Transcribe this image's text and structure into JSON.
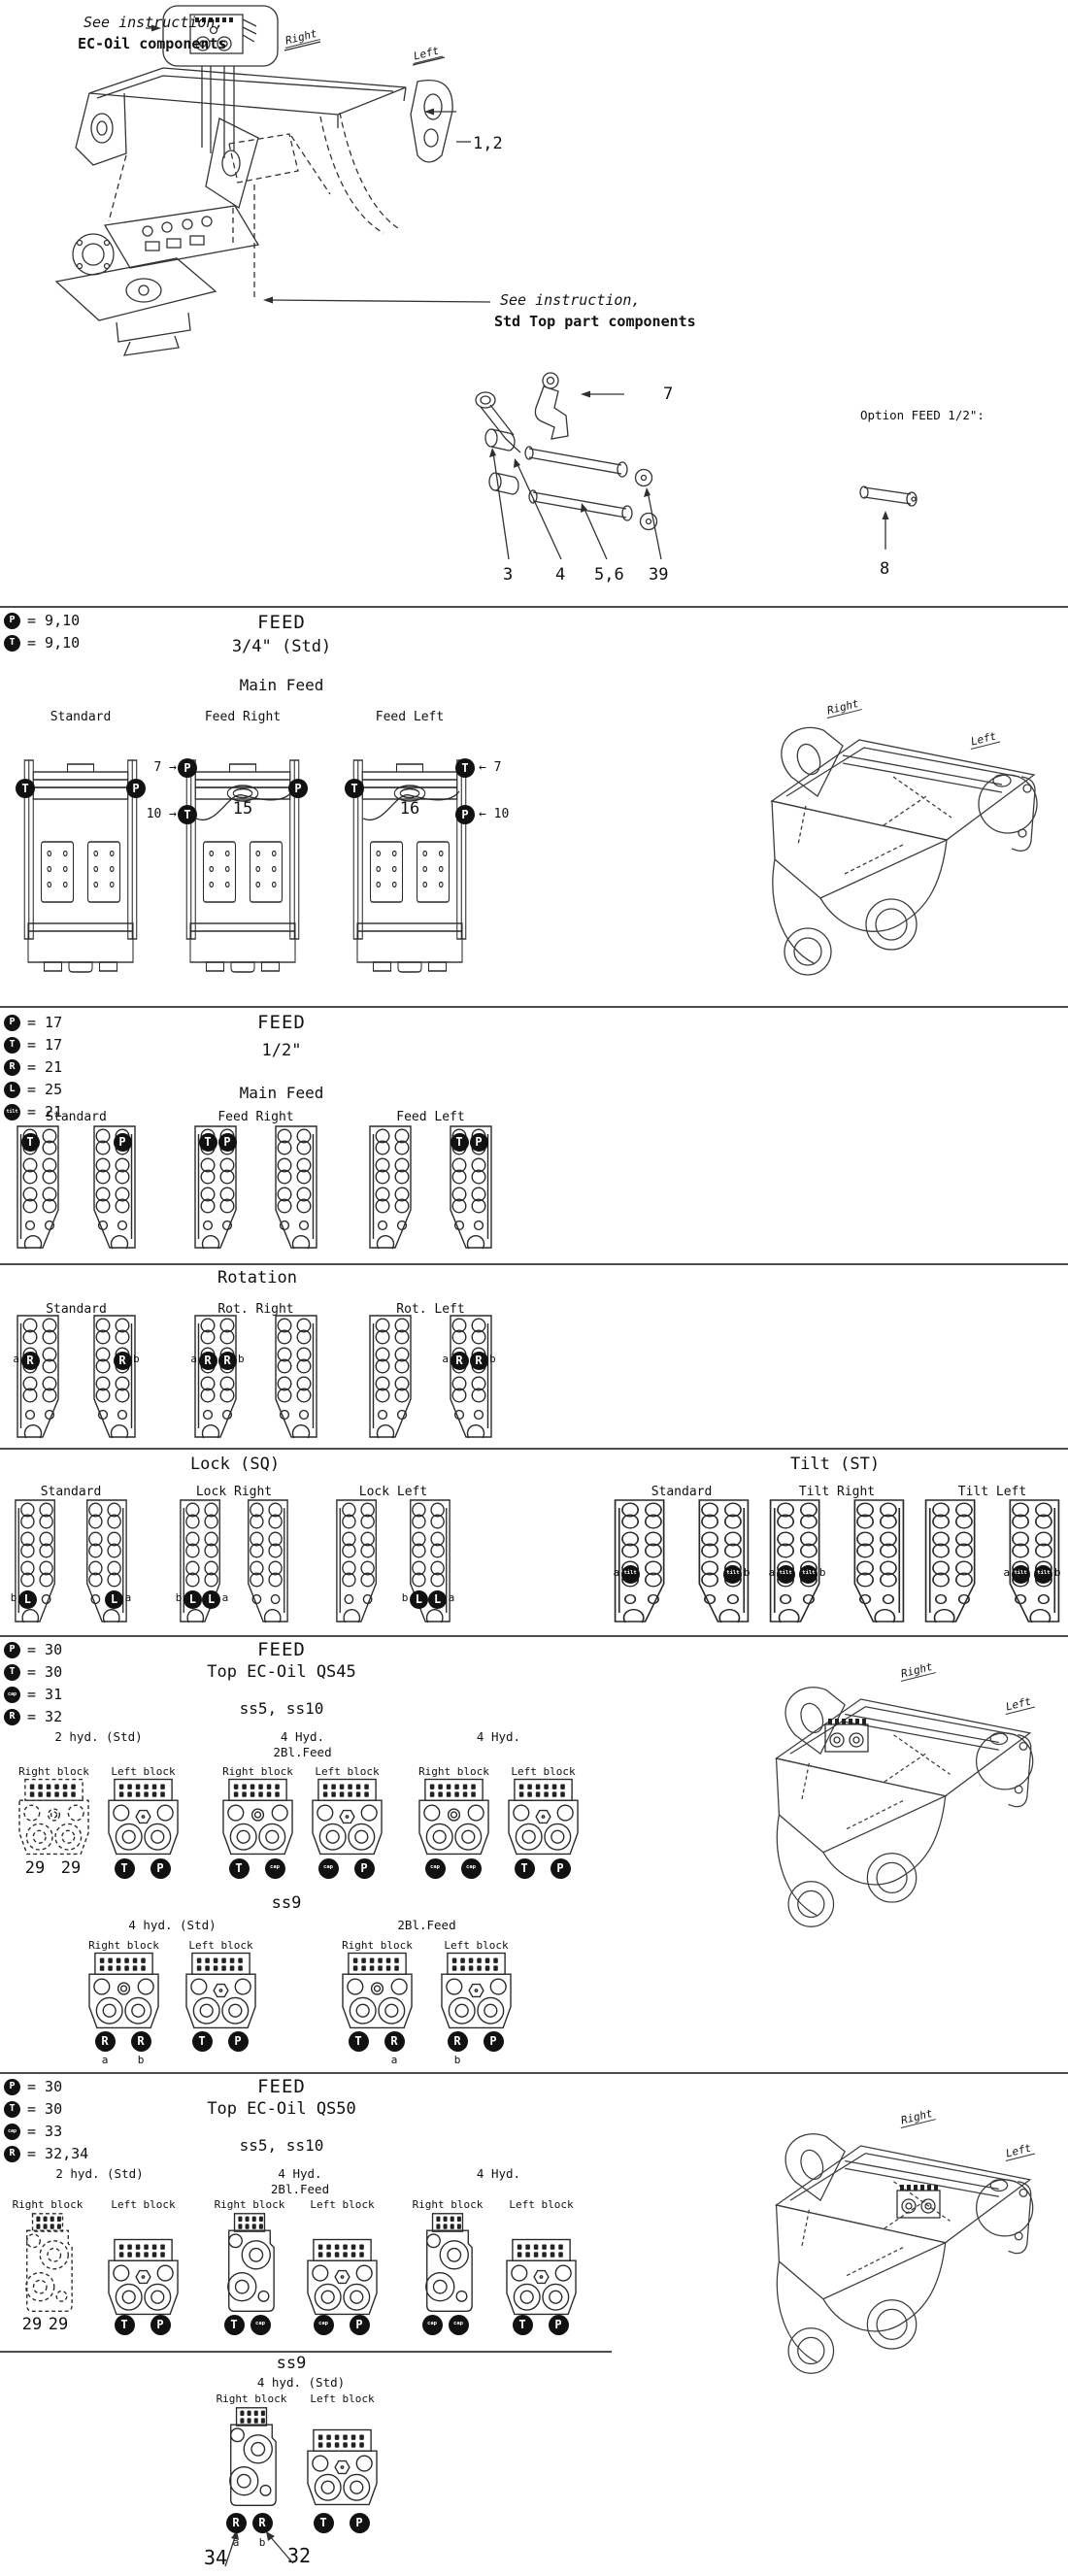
{
  "page": {
    "background": "#ffffff",
    "line_color": "#2a2a2a",
    "marker_fill": "#111111"
  },
  "top": {
    "note_ec_oil_line1": "See instruction,",
    "note_ec_oil_line2": "EC-Oil components",
    "note_std_top_line1": "See instruction,",
    "note_std_top_line2": "Std Top part components",
    "right_label": "Right",
    "left_label": "Left",
    "option_feed_note": "Option FEED 1/2\":",
    "callout_1_2": "1,2",
    "callout_7": "7",
    "callout_8": "8",
    "callout_3": "3",
    "callout_4": "4",
    "callout_5_6": "5,6",
    "callout_39": "39"
  },
  "feed34": {
    "legend": [
      {
        "symbol": "P",
        "value": "9,10"
      },
      {
        "symbol": "T",
        "value": "9,10"
      }
    ],
    "title": "FEED",
    "subtitle": "3/4\" (Std)",
    "group_heading": "Main Feed",
    "brackets": [
      {
        "label": "Standard",
        "left_markers": [
          "T"
        ],
        "right_markers": [
          "P"
        ]
      },
      {
        "label": "Feed Right",
        "left_markers": [
          "P",
          "T"
        ],
        "left_callouts": [
          "7",
          "10"
        ],
        "right_markers": [
          "P"
        ],
        "num": "15"
      },
      {
        "label": "Feed Left",
        "left_markers": [
          "T"
        ],
        "right_markers": [
          "T",
          "P"
        ],
        "right_callouts": [
          "7",
          "10"
        ],
        "num": "16"
      }
    ],
    "coupler_right_label": "Right",
    "coupler_left_label": "Left"
  },
  "feed12": {
    "legend": [
      {
        "symbol": "P",
        "value": "17"
      },
      {
        "symbol": "T",
        "value": "17"
      },
      {
        "symbol": "R",
        "value": "21"
      },
      {
        "symbol": "L",
        "value": "25"
      },
      {
        "symbol": "tilt",
        "value": "21"
      }
    ],
    "title": "FEED",
    "subtitle": "1/2\"",
    "rows": [
      {
        "heading": "Main Feed",
        "columns": [
          {
            "label": "Standard",
            "left_markers": [
              {
                "row": 0,
                "col": 0,
                "symbol": "T"
              }
            ],
            "right_markers": [
              {
                "row": 0,
                "col": 1,
                "symbol": "P"
              }
            ]
          },
          {
            "label": "Feed Right",
            "left_markers": [
              {
                "row": 0,
                "col": 0,
                "symbol": "T"
              },
              {
                "row": 0,
                "col": 1,
                "symbol": "P"
              }
            ],
            "right_markers": []
          },
          {
            "label": "Feed Left",
            "left_markers": [],
            "right_markers": [
              {
                "row": 0,
                "col": 0,
                "symbol": "T"
              },
              {
                "row": 0,
                "col": 1,
                "symbol": "P"
              }
            ]
          }
        ]
      },
      {
        "heading": "Rotation",
        "columns": [
          {
            "label": "Standard",
            "left_markers": [
              {
                "row": 1,
                "col": 0,
                "symbol": "R",
                "letter": "a",
                "letter_side": "left"
              }
            ],
            "right_markers": [
              {
                "row": 1,
                "col": 1,
                "symbol": "R",
                "letter": "b",
                "letter_side": "right"
              }
            ]
          },
          {
            "label": "Rot. Right",
            "left_markers": [
              {
                "row": 1,
                "col": 0,
                "symbol": "R",
                "letter": "a",
                "letter_side": "left"
              },
              {
                "row": 1,
                "col": 1,
                "symbol": "R",
                "letter": "b",
                "letter_side": "right"
              }
            ],
            "right_markers": []
          },
          {
            "label": "Rot. Left",
            "left_markers": [],
            "right_markers": [
              {
                "row": 1,
                "col": 0,
                "symbol": "R",
                "letter": "a",
                "letter_side": "left"
              },
              {
                "row": 1,
                "col": 1,
                "symbol": "R",
                "letter": "b",
                "letter_side": "right"
              }
            ]
          }
        ]
      },
      {
        "heading": "Lock (SQ)",
        "columns": [
          {
            "label": "Standard",
            "left_markers": [
              {
                "row": 3,
                "col": 0,
                "symbol": "L",
                "letter": "b",
                "letter_side": "left"
              }
            ],
            "right_markers": [
              {
                "row": 3,
                "col": 1,
                "symbol": "L",
                "letter": "a",
                "letter_side": "right"
              }
            ]
          },
          {
            "label": "Lock Right",
            "left_markers": [
              {
                "row": 3,
                "col": 0,
                "symbol": "L",
                "letter": "b",
                "letter_side": "left"
              },
              {
                "row": 3,
                "col": 1,
                "symbol": "L",
                "letter": "a",
                "letter_side": "right"
              }
            ],
            "right_markers": []
          },
          {
            "label": "Lock Left",
            "left_markers": [],
            "right_markers": [
              {
                "row": 3,
                "col": 0,
                "symbol": "L",
                "letter": "b",
                "letter_side": "left"
              },
              {
                "row": 3,
                "col": 1,
                "symbol": "L",
                "letter": "a",
                "letter_side": "right"
              }
            ]
          }
        ]
      },
      {
        "heading": "Tilt (ST)",
        "columns": [
          {
            "label": "Standard",
            "left_markers": [
              {
                "row": 2,
                "col": 0,
                "symbol": "tilt",
                "letter": "a",
                "letter_side": "left"
              }
            ],
            "right_markers": [
              {
                "row": 2,
                "col": 1,
                "symbol": "tilt",
                "letter": "b",
                "letter_side": "right"
              }
            ]
          },
          {
            "label": "Tilt Right",
            "left_markers": [
              {
                "row": 2,
                "col": 0,
                "symbol": "tilt",
                "letter": "a",
                "letter_side": "left"
              },
              {
                "row": 2,
                "col": 1,
                "symbol": "tilt",
                "letter": "b",
                "letter_side": "right"
              }
            ],
            "right_markers": []
          },
          {
            "label": "Tilt Left",
            "left_markers": [],
            "right_markers": [
              {
                "row": 2,
                "col": 0,
                "symbol": "tilt",
                "letter": "a",
                "letter_side": "left"
              },
              {
                "row": 2,
                "col": 1,
                "symbol": "tilt",
                "letter": "b",
                "letter_side": "right"
              }
            ]
          }
        ]
      }
    ]
  },
  "qs45": {
    "legend": [
      {
        "symbol": "P",
        "value": "30"
      },
      {
        "symbol": "T",
        "value": "30"
      },
      {
        "symbol": "cap",
        "value": "31"
      },
      {
        "symbol": "R",
        "value": "32"
      }
    ],
    "title": "FEED",
    "subtitle": "Top EC-Oil QS45",
    "ss5_heading": "ss5, ss10",
    "ss9_heading": "ss9",
    "group1": [
      {
        "label_line1": "2 hyd. (Std)",
        "label_line2": "",
        "blocks": [
          {
            "name": "Right block",
            "dashed": true,
            "markers": [
              {
                "number": "29"
              },
              {
                "number": "29"
              }
            ]
          },
          {
            "name": "Left block",
            "markers": [
              {
                "symbol": "T"
              },
              {
                "symbol": "P"
              }
            ]
          }
        ]
      },
      {
        "label_line1": "4 Hyd.",
        "label_line2": "2Bl.Feed",
        "blocks": [
          {
            "name": "Right block",
            "markers": [
              {
                "symbol": "T"
              },
              {
                "symbol": "cap"
              }
            ]
          },
          {
            "name": "Left block",
            "markers": [
              {
                "symbol": "cap"
              },
              {
                "symbol": "P"
              }
            ]
          }
        ]
      },
      {
        "label_line1": "4 Hyd.",
        "label_line2": "",
        "blocks": [
          {
            "name": "Right block",
            "markers": [
              {
                "symbol": "cap"
              },
              {
                "symbol": "cap"
              }
            ]
          },
          {
            "name": "Left block",
            "markers": [
              {
                "symbol": "T"
              },
              {
                "symbol": "P"
              }
            ]
          }
        ]
      }
    ],
    "group2": [
      {
        "label_line1": "4 hyd. (Std)",
        "label_line2": "",
        "blocks": [
          {
            "name": "Right block",
            "markers": [
              {
                "symbol": "R",
                "letter": "a"
              },
              {
                "symbol": "R",
                "letter": "b"
              }
            ]
          },
          {
            "name": "Left block",
            "markers": [
              {
                "symbol": "T"
              },
              {
                "symbol": "P"
              }
            ]
          }
        ]
      },
      {
        "label_line1": "2Bl.Feed",
        "label_line2": "",
        "blocks": [
          {
            "name": "Right block",
            "markers": [
              {
                "symbol": "T"
              },
              {
                "symbol": "R",
                "letter": "a"
              }
            ]
          },
          {
            "name": "Left block",
            "markers": [
              {
                "symbol": "R",
                "letter": "b"
              },
              {
                "symbol": "P"
              }
            ]
          }
        ]
      }
    ],
    "coupler_right_label": "Right",
    "coupler_left_label": "Left"
  },
  "qs50": {
    "legend": [
      {
        "symbol": "P",
        "value": "30"
      },
      {
        "symbol": "T",
        "value": "30"
      },
      {
        "symbol": "cap",
        "value": "33"
      },
      {
        "symbol": "R",
        "value": "32,34"
      }
    ],
    "title": "FEED",
    "subtitle": "Top EC-Oil QS50",
    "ss5_heading": "ss5, ss10",
    "ss9_heading": "ss9",
    "group1": [
      {
        "label_line1": "2 hyd. (Std)",
        "label_line2": "",
        "blocks": [
          {
            "name": "Right block",
            "dashed": true,
            "markers": [
              {
                "number": "29"
              },
              {
                "number": "29"
              }
            ]
          },
          {
            "name": "Left block",
            "markers": [
              {
                "symbol": "T"
              },
              {
                "symbol": "P"
              }
            ]
          }
        ]
      },
      {
        "label_line1": "4 Hyd.",
        "label_line2": "2Bl.Feed",
        "blocks": [
          {
            "name": "Right block",
            "markers": [
              {
                "symbol": "T"
              },
              {
                "symbol": "cap"
              }
            ]
          },
          {
            "name": "Left block",
            "markers": [
              {
                "symbol": "cap"
              },
              {
                "symbol": "P"
              }
            ]
          }
        ]
      },
      {
        "label_line1": "4 Hyd.",
        "label_line2": "",
        "blocks": [
          {
            "name": "Right block",
            "markers": [
              {
                "symbol": "cap"
              },
              {
                "symbol": "cap"
              }
            ]
          },
          {
            "name": "Left block",
            "markers": [
              {
                "symbol": "T"
              },
              {
                "symbol": "P"
              }
            ]
          }
        ]
      }
    ],
    "group2": [
      {
        "label_line1": "4 hyd. (Std)",
        "label_line2": "",
        "blocks": [
          {
            "name": "Right block",
            "markers": [
              {
                "symbol": "R",
                "letter": "a"
              },
              {
                "symbol": "R",
                "letter": "b"
              }
            ]
          },
          {
            "name": "Left block",
            "markers": [
              {
                "symbol": "T"
              },
              {
                "symbol": "P"
              }
            ]
          }
        ]
      }
    ],
    "callout_34": "34",
    "callout_32": "32",
    "coupler_right_label": "Right",
    "coupler_left_label": "Left"
  }
}
